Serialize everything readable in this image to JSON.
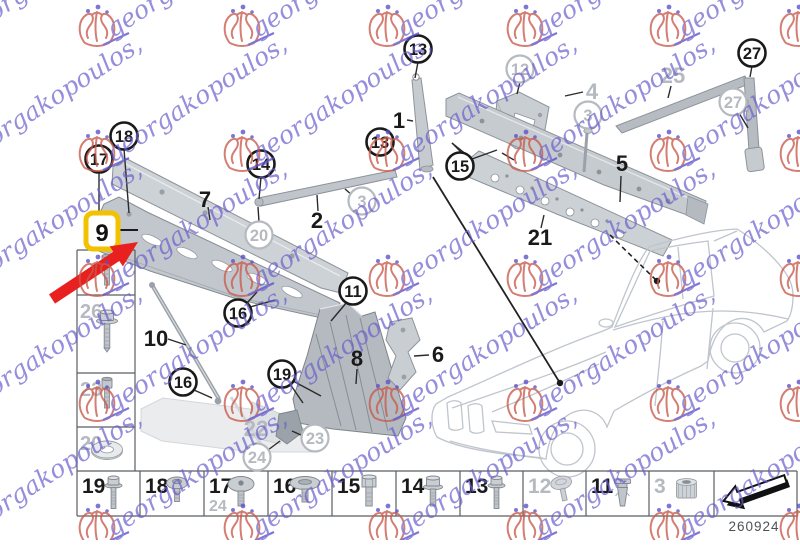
{
  "watermark": {
    "text": "georgakopoulos,",
    "crest_color": "#c95a4c",
    "accent_color": "#5a50c8",
    "text_color": "#6a5fce"
  },
  "diagram": {
    "callouts": [
      {
        "label": "13",
        "tone": "black"
      },
      {
        "label": "13",
        "tone": "black"
      },
      {
        "label": "14",
        "tone": "black"
      },
      {
        "label": "15",
        "tone": "black"
      },
      {
        "label": "17",
        "tone": "black"
      },
      {
        "label": "18",
        "tone": "black"
      },
      {
        "label": "16",
        "tone": "black"
      },
      {
        "label": "16",
        "tone": "black"
      },
      {
        "label": "11",
        "tone": "black"
      },
      {
        "label": "19",
        "tone": "black"
      },
      {
        "label": "27",
        "tone": "black"
      },
      {
        "label": "12",
        "tone": "gray"
      },
      {
        "label": "3",
        "tone": "gray"
      },
      {
        "label": "3",
        "tone": "gray"
      },
      {
        "label": "20",
        "tone": "gray"
      },
      {
        "label": "27",
        "tone": "gray"
      },
      {
        "label": "23",
        "tone": "gray"
      },
      {
        "label": "24",
        "tone": "gray"
      }
    ],
    "labels": [
      {
        "label": "1",
        "tone": "black"
      },
      {
        "label": "2",
        "tone": "black"
      },
      {
        "label": "5",
        "tone": "black"
      },
      {
        "label": "7",
        "tone": "black"
      },
      {
        "label": "8",
        "tone": "black"
      },
      {
        "label": "6",
        "tone": "black"
      },
      {
        "label": "10",
        "tone": "black"
      },
      {
        "label": "21",
        "tone": "black"
      },
      {
        "label": "25",
        "tone": "gray"
      },
      {
        "label": "4",
        "tone": "gray"
      },
      {
        "label": "22",
        "tone": "gray"
      }
    ],
    "highlight": {
      "label": "9",
      "box_color": "#f2c100",
      "arrow_color": "#e8201f"
    },
    "gray_tone": "#b5bac0",
    "black_tone": "#1a1a1a"
  },
  "left_column": {
    "cells": [
      {
        "label": "",
        "tone": "gray",
        "item": "socket-bolt"
      },
      {
        "label": "26",
        "tone": "gray",
        "item": "flange-bolt-large"
      },
      {
        "label": "23",
        "tone": "gray",
        "item": "socket-bolt"
      },
      {
        "label": "20",
        "tone": "gray",
        "item": "washer"
      }
    ]
  },
  "bottom_row": {
    "cells": [
      {
        "label": "19",
        "tone": "black",
        "item": "flange-bolt-long",
        "sub_label": ""
      },
      {
        "label": "18",
        "tone": "black",
        "item": "washer-head-screw",
        "sub_label": ""
      },
      {
        "label": "17",
        "tone": "black",
        "item": "dome-head-screw",
        "sub_label": "24"
      },
      {
        "label": "16",
        "tone": "black",
        "item": "flat-head-screw",
        "sub_label": ""
      },
      {
        "label": "15",
        "tone": "black",
        "item": "hex-bolt",
        "sub_label": ""
      },
      {
        "label": "14",
        "tone": "black",
        "item": "flange-bolt",
        "sub_label": ""
      },
      {
        "label": "13",
        "tone": "black",
        "item": "flange-bolt-long",
        "sub_label": ""
      },
      {
        "label": "12",
        "tone": "gray",
        "item": "button-head-screw",
        "sub_label": ""
      },
      {
        "label": "11",
        "tone": "black",
        "item": "expansion-rivet",
        "sub_label": ""
      },
      {
        "label": "3",
        "tone": "gray",
        "item": "knurled-nut",
        "sub_label": ""
      },
      {
        "label": "",
        "tone": "black",
        "item": "back-arrow",
        "sub_label": ""
      }
    ]
  },
  "footer": {
    "code": "260924"
  }
}
